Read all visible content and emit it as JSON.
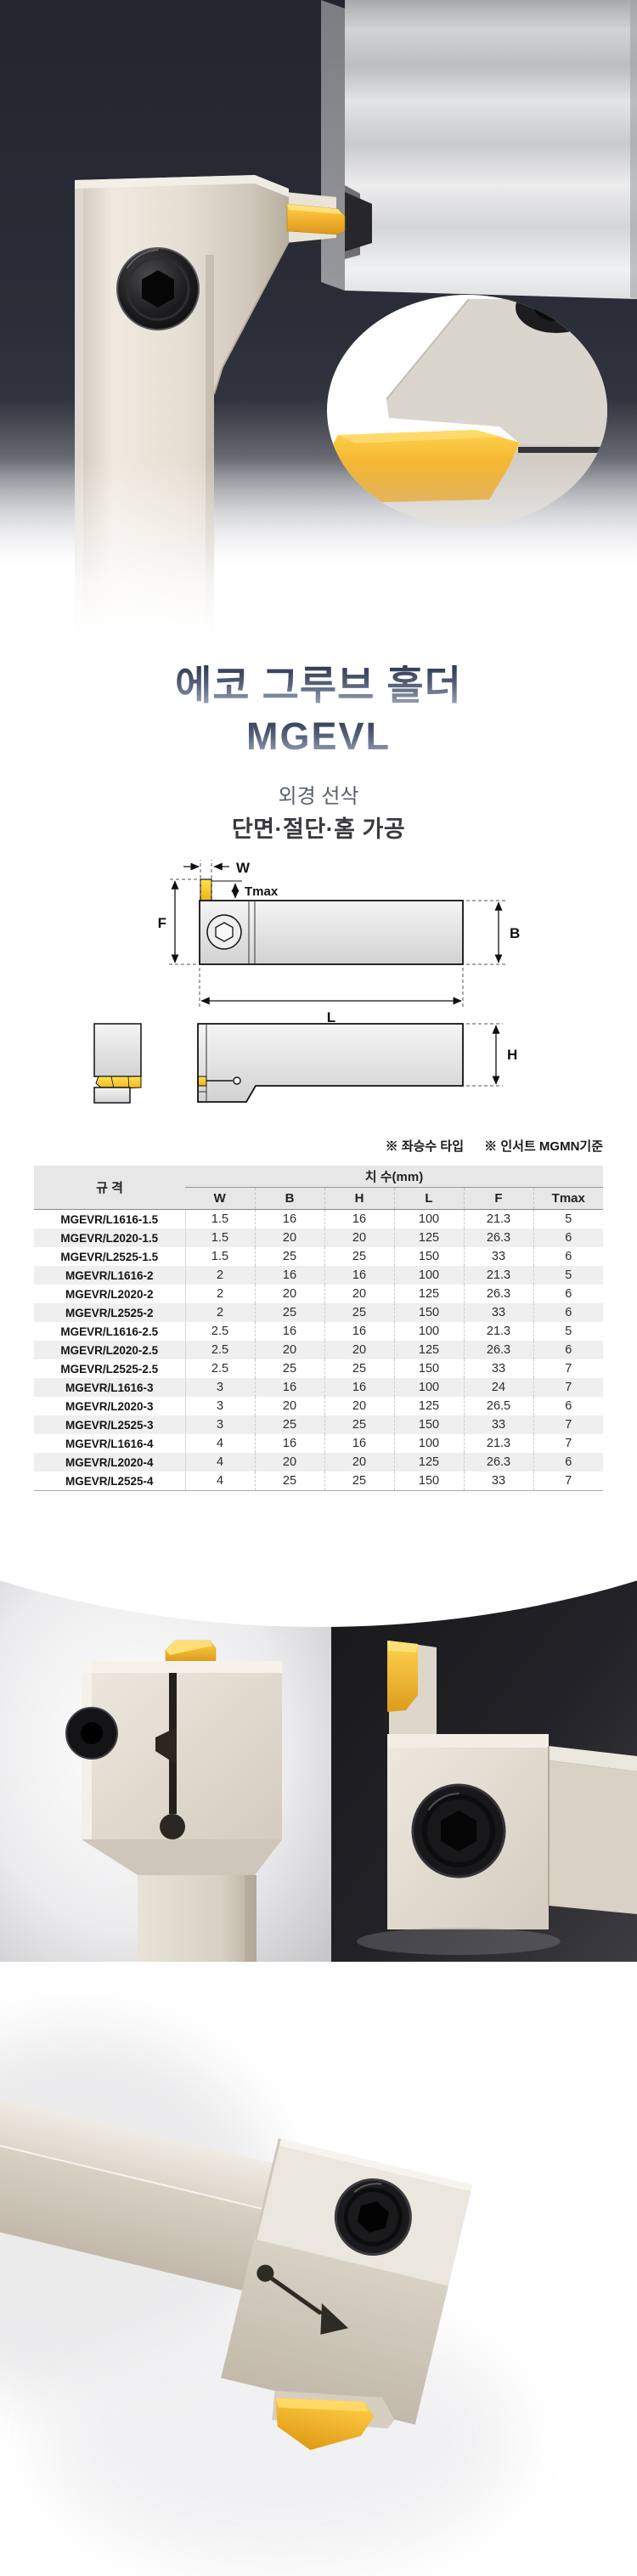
{
  "product": {
    "title_line1": "에코 그루브 홀더",
    "title_line2": "MGEVL",
    "subtitle_line1": "외경 선삭",
    "subtitle_line2": "단면·절단·홈 가공"
  },
  "notes": {
    "hand_type": "※ 좌승수 타입",
    "insert_standard": "※ 인서트 MGMN기준"
  },
  "diagram": {
    "labels": {
      "w": "W",
      "tmax": "Tmax",
      "f": "F",
      "b": "B",
      "l": "L",
      "h": "H"
    }
  },
  "table": {
    "spec_header": "규 격",
    "dim_header": "치 수(mm)",
    "columns": [
      "W",
      "B",
      "H",
      "L",
      "F",
      "Tmax"
    ],
    "rows": [
      {
        "spec": "MGEVR/L1616-1.5",
        "values": [
          "1.5",
          "16",
          "16",
          "100",
          "21.3",
          "5"
        ]
      },
      {
        "spec": "MGEVR/L2020-1.5",
        "values": [
          "1.5",
          "20",
          "20",
          "125",
          "26.3",
          "6"
        ]
      },
      {
        "spec": "MGEVR/L2525-1.5",
        "values": [
          "1.5",
          "25",
          "25",
          "150",
          "33",
          "6"
        ]
      },
      {
        "spec": "MGEVR/L1616-2",
        "values": [
          "2",
          "16",
          "16",
          "100",
          "21.3",
          "5"
        ]
      },
      {
        "spec": "MGEVR/L2020-2",
        "values": [
          "2",
          "20",
          "20",
          "125",
          "26.3",
          "6"
        ]
      },
      {
        "spec": "MGEVR/L2525-2",
        "values": [
          "2",
          "25",
          "25",
          "150",
          "33",
          "6"
        ]
      },
      {
        "spec": "MGEVR/L1616-2.5",
        "values": [
          "2.5",
          "16",
          "16",
          "100",
          "21.3",
          "5"
        ]
      },
      {
        "spec": "MGEVR/L2020-2.5",
        "values": [
          "2.5",
          "20",
          "20",
          "125",
          "26.3",
          "6"
        ]
      },
      {
        "spec": "MGEVR/L2525-2.5",
        "values": [
          "2.5",
          "25",
          "25",
          "150",
          "33",
          "7"
        ]
      },
      {
        "spec": "MGEVR/L1616-3",
        "values": [
          "3",
          "16",
          "16",
          "100",
          "24",
          "7"
        ]
      },
      {
        "spec": "MGEVR/L2020-3",
        "values": [
          "3",
          "20",
          "20",
          "125",
          "26.5",
          "6"
        ]
      },
      {
        "spec": "MGEVR/L2525-3",
        "values": [
          "3",
          "25",
          "25",
          "150",
          "33",
          "7"
        ]
      },
      {
        "spec": "MGEVR/L1616-4",
        "values": [
          "4",
          "16",
          "16",
          "100",
          "21.3",
          "7"
        ]
      },
      {
        "spec": "MGEVR/L2020-4",
        "values": [
          "4",
          "20",
          "20",
          "125",
          "26.3",
          "6"
        ]
      },
      {
        "spec": "MGEVR/L2525-4",
        "values": [
          "4",
          "25",
          "25",
          "150",
          "33",
          "7"
        ]
      }
    ]
  },
  "colors": {
    "hero_background": "#262a34",
    "insert_gold": "#f2b32e",
    "title_gradient_top": "#2e3a52",
    "title_gradient_bottom": "#9aa5b6",
    "table_header_bg": "#e7e7e7"
  }
}
